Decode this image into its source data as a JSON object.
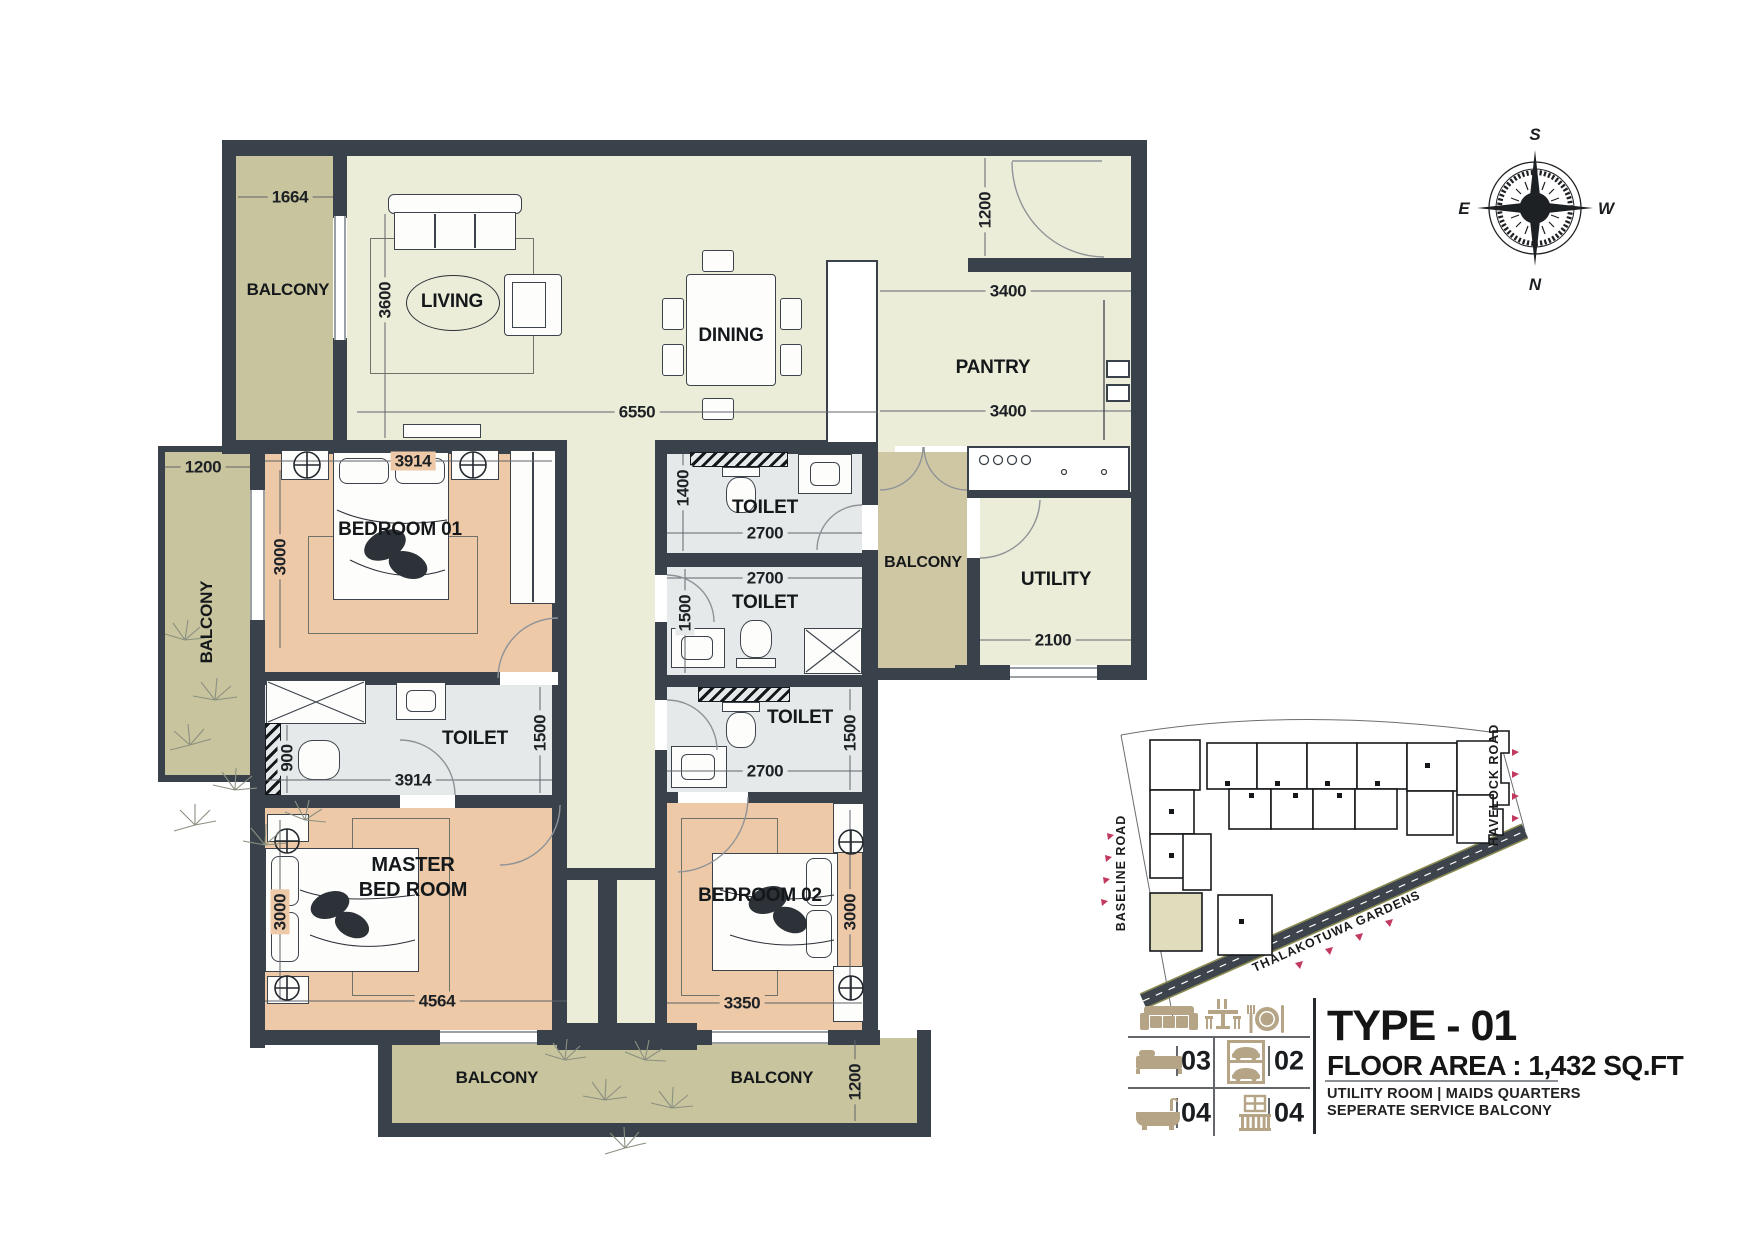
{
  "rooms": {
    "balcony_top_left": "BALCONY",
    "living": "LIVING",
    "dining": "DINING",
    "pantry": "PANTRY",
    "utility": "UTILITY",
    "balcony_service": "BALCONY",
    "balcony_left": "BALCONY",
    "bedroom_01": "BEDROOM 01",
    "toilet_1": "TOILET",
    "toilet_2": "TOILET",
    "toilet_3": "TOILET",
    "master_toilet": "TOILET",
    "master_bedroom": "MASTER BED ROOM",
    "bedroom_02": "BEDROOM 02",
    "balcony_bottom_left": "BALCONY",
    "balcony_bottom_right": "BALCONY"
  },
  "dimensions": {
    "balcony_top_left_width": "1664",
    "living_depth": "3600",
    "living_dining_width": "6550",
    "entry_recess": "1200",
    "pantry_width_upper": "3400",
    "pantry_width_lower": "3400",
    "balcony_left_width": "1200",
    "bedroom_01_width": "3914",
    "bedroom_01_depth": "3000",
    "toilet_1_depth": "1400",
    "toilet_1_width": "2700",
    "toilet_2_width": "2700",
    "toilet_2_depth": "1500",
    "utility_width": "2100",
    "master_toilet_nook": "900",
    "master_toilet_width": "3914",
    "master_toilet_depth": "1500",
    "toilet_3_width": "2700",
    "toilet_3_depth": "1500",
    "master_bedroom_depth": "3000",
    "master_bedroom_width": "4564",
    "bedroom_02_width": "3350",
    "bedroom_02_depth": "3000",
    "balcony_bottom_right_depth": "1200"
  },
  "compass": {
    "south": "S",
    "east": "E",
    "west": "W",
    "north": "N"
  },
  "site_map": {
    "baseline_road": "BASELINE ROAD",
    "havelock_road": "HAVELOCK ROAD",
    "thalakotuwa_gardens": "THALAKOTUWA GARDENS"
  },
  "legend": {
    "type_title": "TYPE - 01",
    "floor_area": "FLOOR AREA : 1,432 SQ.FT",
    "note_line_1": "UTILITY ROOM | MAIDS QUARTERS",
    "note_line_2": "SEPERATE SERVICE BALCONY",
    "bedroom_count": "03",
    "parking_count": "02",
    "bathroom_count": "04",
    "balcony_count": "04",
    "icons": {
      "furniture_row": [
        "sofa-icon",
        "dining-table-icon",
        "dinner-plate-icon"
      ],
      "bedroom": "bed-icon",
      "parking": "car-parking-icon",
      "bathroom": "bathtub-icon",
      "balcony": "balcony-railing-icon"
    }
  },
  "colors": {
    "wall": "#39414a",
    "living_floor": "#ecedd8",
    "bedroom_floor": "#edc9a7",
    "toilet_floor": "#e6e9e9",
    "balcony_floor": "#c8c49e",
    "service_balcony_floor": "#cfc7a3",
    "legend_icon": "#b5a586",
    "road_arrow": "#c23a60",
    "site_highlight": "#e0ddbd"
  }
}
